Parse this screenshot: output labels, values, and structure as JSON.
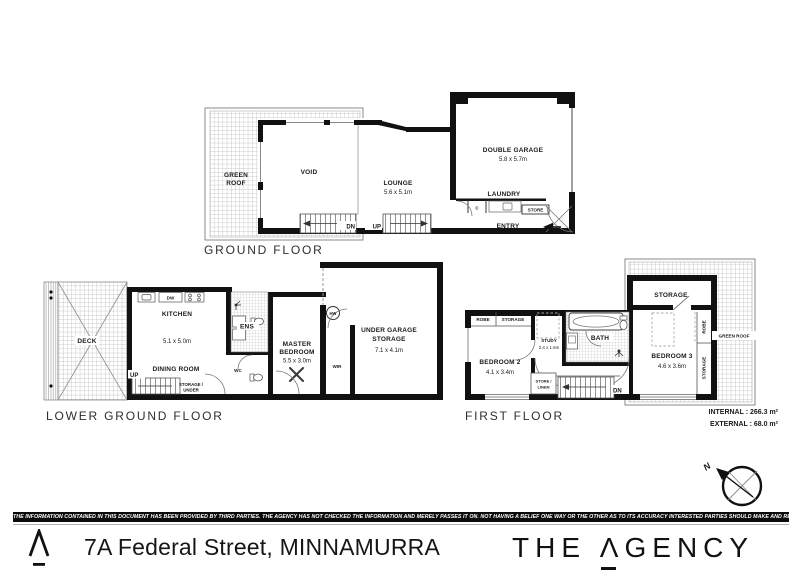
{
  "colors": {
    "ink": "#111111",
    "hatch": "#b8b8b8",
    "bar": "#0b0b0b"
  },
  "compass": {
    "north": "N"
  },
  "areas": {
    "internal": "INTERNAL : 266.3 m²",
    "external": "EXTERNAL : 68.0 m²"
  },
  "floors": {
    "ground": {
      "label": "GROUND FLOOR",
      "rooms": {
        "green_roof_1": "GREEN",
        "green_roof_2": "ROOF",
        "void": "VOID",
        "lounge": "LOUNGE",
        "lounge_dim": "5.6 x 5.1m",
        "garage": "DOUBLE GARAGE",
        "garage_dim": "5.8 x 5.7m",
        "laundry": "LAUNDRY",
        "closet_c": "C",
        "store": "STORE",
        "entry": "ENTRY",
        "stairs_dn": "DN",
        "stairs_up": "UP"
      }
    },
    "lower": {
      "label": "LOWER GROUND FLOOR",
      "rooms": {
        "deck": "DECK",
        "kitchen": "KITCHEN",
        "kitchen_dim": "5.1 x 5.0m",
        "dining": "DINING ROOM",
        "dw": "DW",
        "ens": "ENS",
        "wc": "WC",
        "hw": "HW",
        "master_1": "MASTER",
        "master_2": "BEDROOM",
        "master_dim": "5.5 x 3.0m",
        "wir": "WIR",
        "ugs_1": "UNDER GARAGE",
        "ugs_2": "STORAGE",
        "ugs_dim": "7.1 x 4.1m",
        "stairs_up": "UP",
        "sus_1": "STORAGE /",
        "sus_2": "UNDER",
        "sus_3": "STAIRS"
      }
    },
    "first": {
      "label": "FIRST FLOOR",
      "rooms": {
        "storage_top": "STORAGE",
        "robe": "ROBE",
        "storage_small": "STORAGE",
        "bed2": "BEDROOM 2",
        "bed2_dim": "4.1 x 3.4m",
        "study": "STUDY",
        "study_dim": "2.4 x 1.6m",
        "bath": "BATH",
        "bed3": "BEDROOM 3",
        "bed3_dim": "4.6 x 3.6m",
        "robe_v": "ROBE",
        "storage_v": "STORAGE",
        "green_roof": "GREEN ROOF",
        "store_linen_1": "STORE /",
        "store_linen_2": "LINEN",
        "stairs_dn": "DN"
      }
    }
  },
  "footer": {
    "disclaimer": "THE INFORMATION CONTAINED IN THIS DOCUMENT HAS BEEN PROVIDED BY THIRD PARTIES. THE AGENCY HAS NOT CHECKED THE INFORMATION AND MERELY PASSES IT ON. NOT HAVING A BELIEF ONE WAY OR  THE OTHER AS TO ITS ACCURACY   INTERESTED PARTIES SHOULD MAKE AND RELY UPON THEIR OWN ENQUIRIES.",
    "address": "7A Federal Street, MINNAMURRA",
    "brand_the": "THE",
    "brand_a": "Λ",
    "brand_gency": "GENCY"
  }
}
